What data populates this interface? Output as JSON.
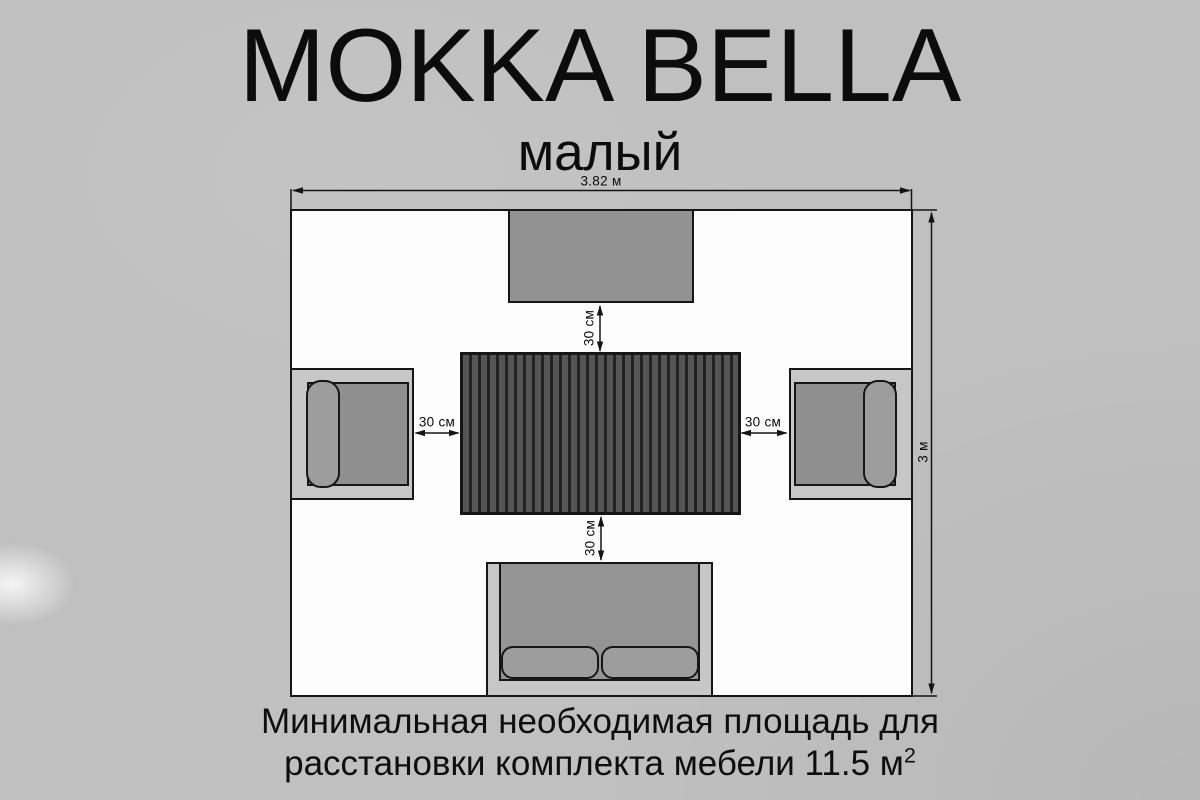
{
  "title": "MOKKA BELLA",
  "subtitle": "малый",
  "dim_labels": {
    "room_width": "3.82 м",
    "room_height": "3 м",
    "gap_top": "30 см",
    "gap_bottom": "30 см",
    "gap_left": "30 см",
    "gap_right": "30 см"
  },
  "caption": {
    "line1": "Минимальная необходимая площадь для",
    "line2": "расстановки комплекта мебели 11.5 м",
    "line2_superscript": "2"
  },
  "furniture_semantics": {
    "top": "bench-top-view",
    "center": "slatted-dining-table-top-view",
    "left": "armchair-left-top-view",
    "right": "armchair-right-top-view",
    "bottom": "two-seat-sofa-top-view"
  },
  "colors": {
    "background": "#c0c0c0",
    "room_fill": "#fdfdfd",
    "outline": "#161616",
    "bench_fill": "#929292",
    "table_slat": "#555555",
    "table_groove": "#222222",
    "frame_light": "#c7c7c7",
    "seat_gray": "#8f8f8f",
    "sofa_seat": "#949494",
    "cushion_gray": "#9d9d9d"
  }
}
